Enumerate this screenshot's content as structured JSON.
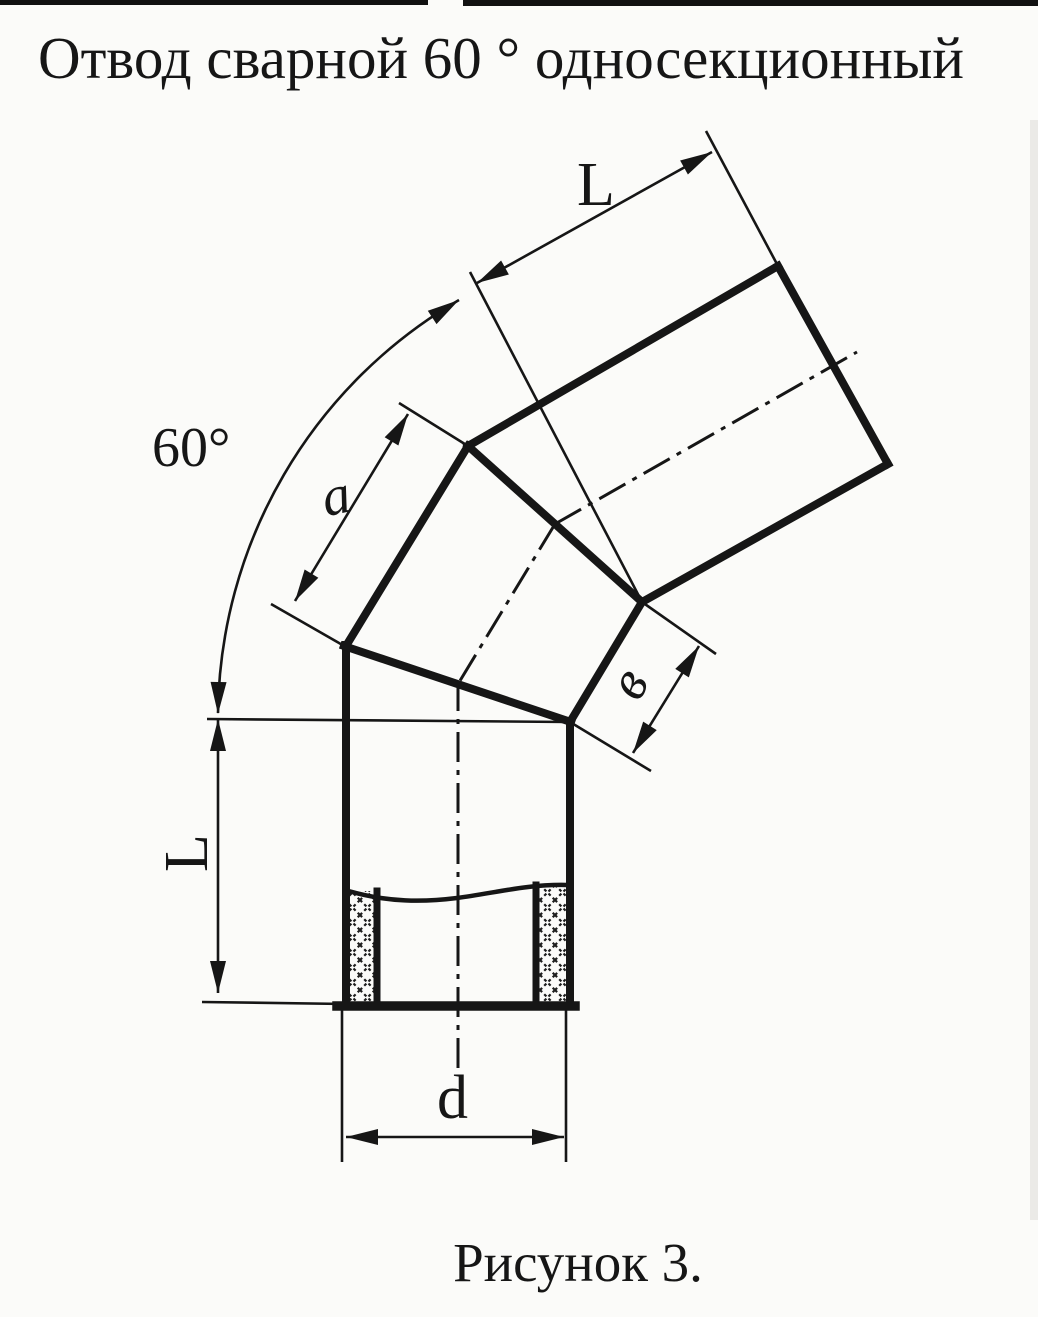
{
  "title": "Отвод сварной 60 ° односекционный",
  "caption": "Рисунок 3.",
  "labels": {
    "angle": "60°",
    "length_top": "L",
    "section_side": "a",
    "section_width": "в",
    "length_left": "L",
    "diameter": "d"
  },
  "colors": {
    "ink": "#161616",
    "paper": "#fbfbf9"
  }
}
